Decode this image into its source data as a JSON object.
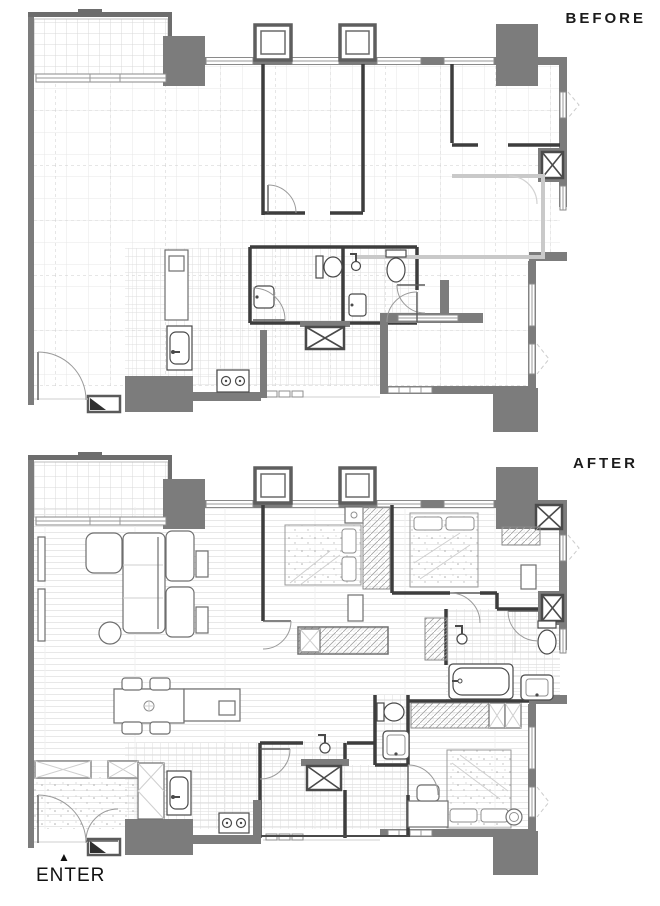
{
  "sheet": {
    "type": "renovation-floor-plan-comparison",
    "background": "#ffffff"
  },
  "labels": {
    "before": "BEFORE",
    "after": "AFTER",
    "enter": "ENTER",
    "enter_arrow": "▲"
  },
  "colors": {
    "wall": "#7c7c7c",
    "wall_dark": "#6d6d6d",
    "partition": "#3d3d3d",
    "fixture_line": "#4a4a4a",
    "tile_grid": "#dddddd",
    "floor_grid": "#e7e7e7",
    "dashed_grid": "#cdcdcd",
    "demolished_wall": "#c9c9c9",
    "label_text": "#1b1b1b"
  },
  "plans": {
    "before": {
      "label": "BEFORE",
      "areas": [
        "balcony",
        "open-living-area",
        "room",
        "room",
        "master-room",
        "bathroom-1",
        "bathroom-2",
        "kitchen",
        "entry"
      ],
      "symbols": [
        "toilet-icon",
        "sink-icon",
        "shower-icon",
        "stove-icon",
        "refrigerator-icon",
        "door-swing-icon",
        "window-icon",
        "shaft-x-icon",
        "column",
        "demolished-wall"
      ]
    },
    "after": {
      "label": "AFTER",
      "areas": [
        "balcony",
        "living-room",
        "dining-area",
        "kitchen",
        "entry",
        "bedroom-1",
        "bedroom-2",
        "bedroom-3",
        "master-bathroom",
        "shower-bathroom",
        "hall-bathroom",
        "hallway"
      ],
      "symbols": [
        "sofa-icon",
        "armchair-icon",
        "coffee-table-icon",
        "tv-cabinet-icon",
        "dining-table-icon",
        "kitchen-island-icon",
        "bed-icon",
        "wardrobe-icon",
        "desk-icon",
        "bathtub-icon",
        "toilet-icon",
        "sink-icon",
        "shower-icon",
        "stove-icon",
        "door-swing-icon",
        "window-icon",
        "shaft-x-icon"
      ]
    }
  }
}
